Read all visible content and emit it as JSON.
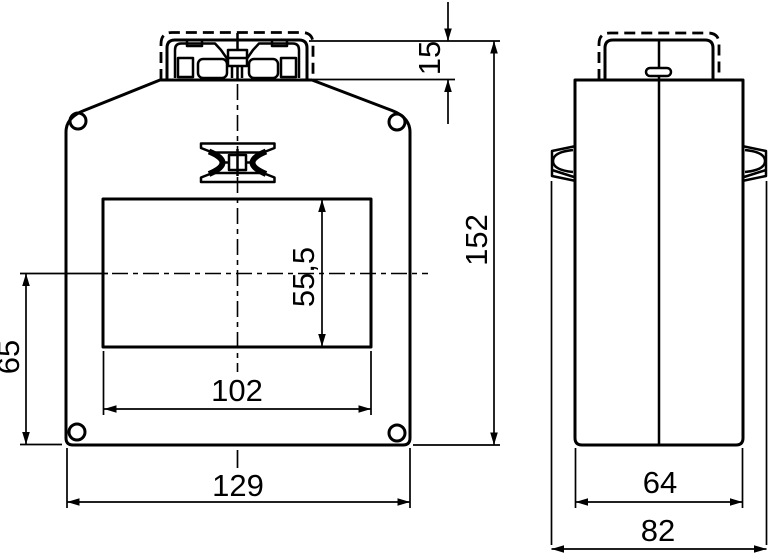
{
  "drawing": {
    "kind": "technical-dimension-drawing",
    "units": "mm",
    "background_color": "#ffffff",
    "line_color": "#000000",
    "views": {
      "front": {
        "dims": {
          "terminal_height": "15",
          "overall_height": "152",
          "window_height": "55,5",
          "window_width": "102",
          "base_to_window_center": "65",
          "overall_width": "129"
        }
      },
      "side": {
        "dims": {
          "body_depth": "64",
          "overall_depth": "82"
        }
      }
    }
  }
}
